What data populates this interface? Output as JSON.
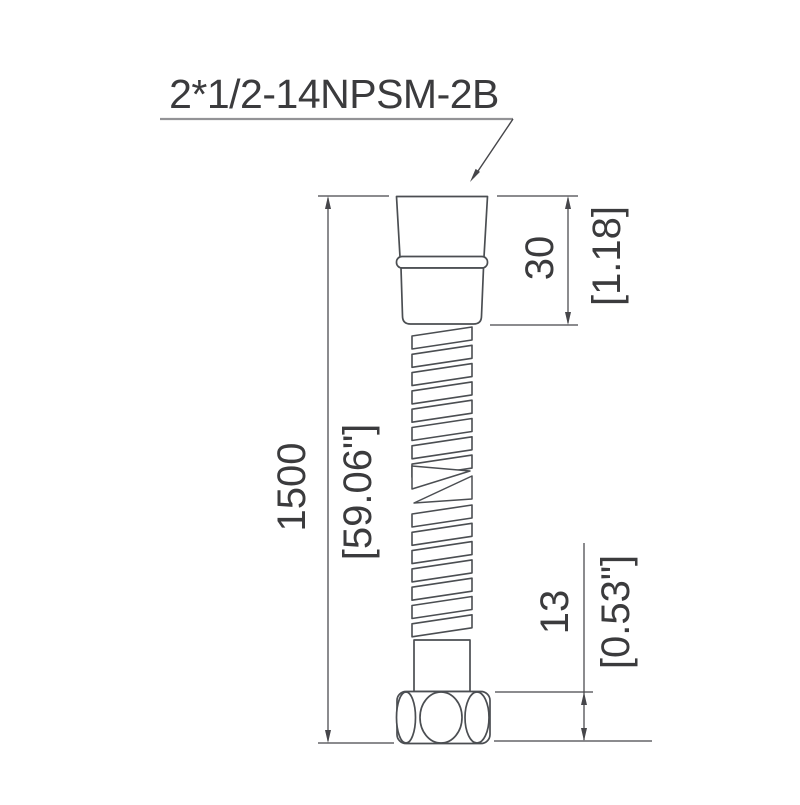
{
  "drawing": {
    "title_label": "2*1/2-14NPSM-2B",
    "view": "side elevation of flexible hose with conical nut, spiral hose body, ferrule and coupling nut"
  },
  "dimensions": {
    "overall_length": {
      "mm": "1500",
      "inch": "[59.06\"]"
    },
    "top_connector_height": {
      "mm": "30",
      "inch": "[1.18]"
    },
    "bottom_nut_height": {
      "mm": "13",
      "inch": "[0.53\"]"
    }
  },
  "colors": {
    "line_color": "#4b4e52",
    "dim_color": "#46464a",
    "text_color": "#3b3b3d",
    "underline_color": "#939396",
    "background_color": "#ffffff"
  }
}
